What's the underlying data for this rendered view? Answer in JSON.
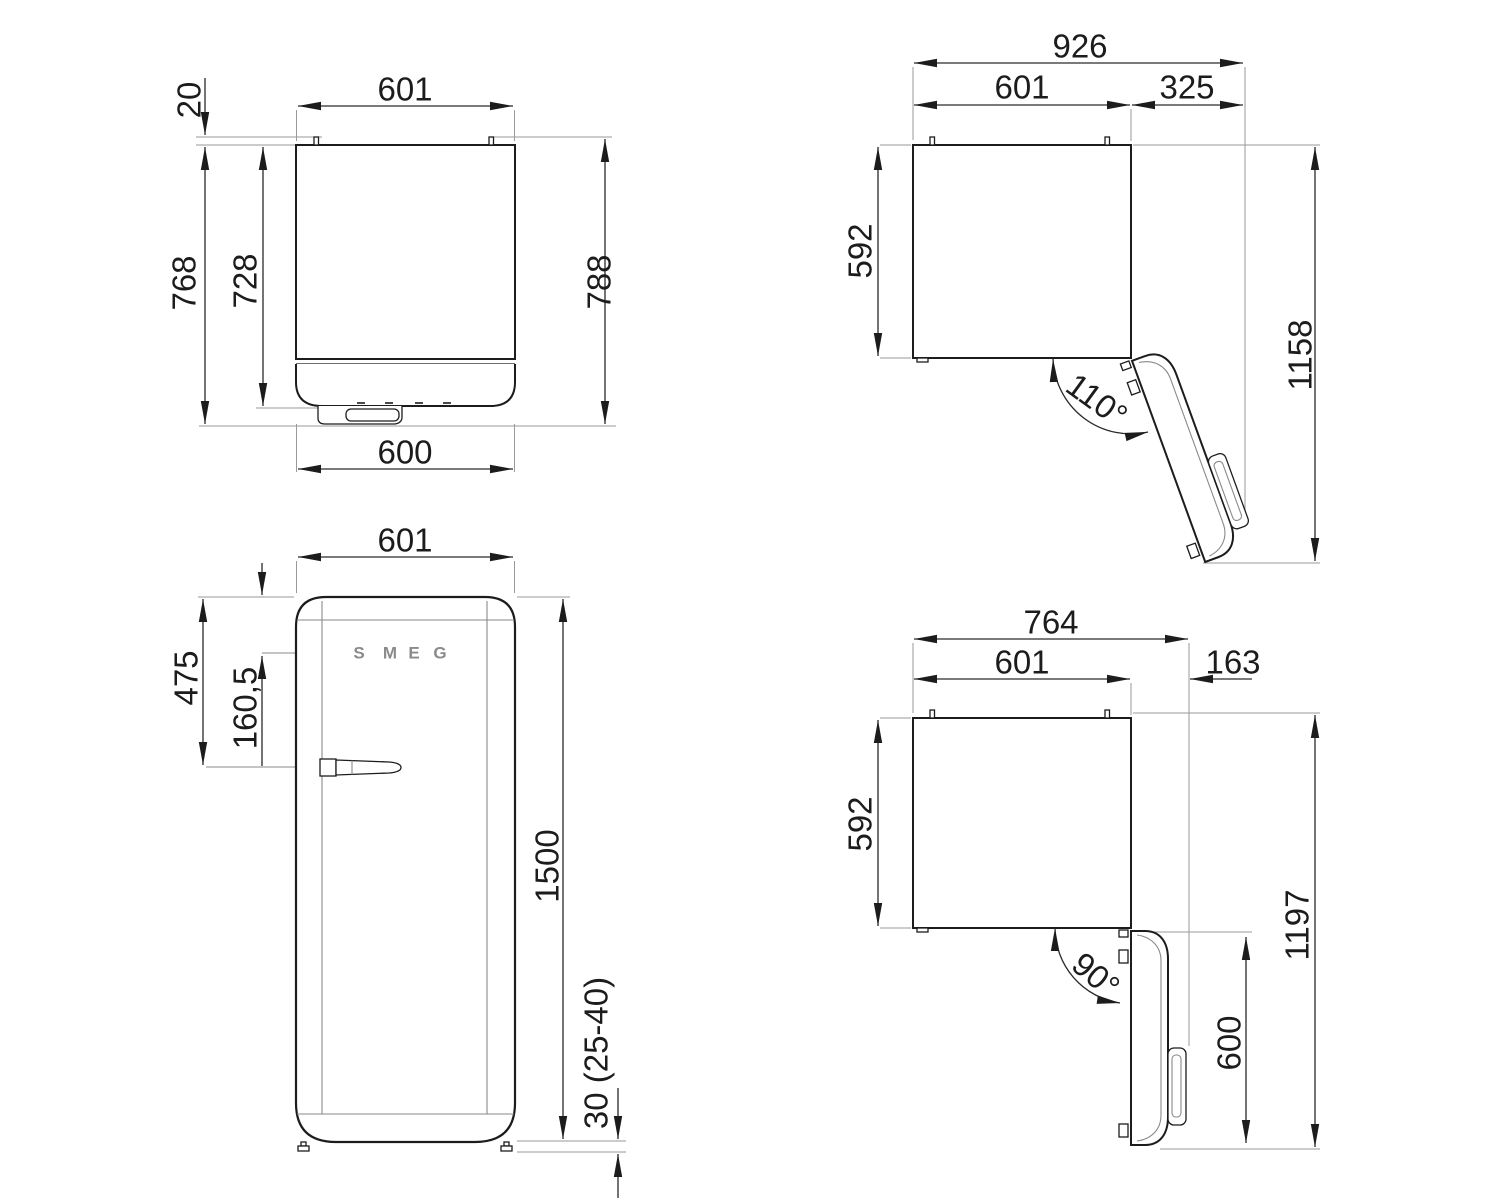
{
  "views": {
    "plan_closed": {
      "title_hint": "top view, door closed",
      "dims": {
        "width_top": "601",
        "hinge_pin_offset": "20",
        "depth_overall": "768",
        "depth_body": "728",
        "depth_with_hinges": "788",
        "door_width": "600"
      }
    },
    "plan_open_110": {
      "title_hint": "top view, door open 110 degrees",
      "dims": {
        "overall_width": "926",
        "body_width": "601",
        "door_clearance": "325",
        "body_depth": "592",
        "overall_depth_open": "1158",
        "door_angle": "110°"
      }
    },
    "front": {
      "title_hint": "front view",
      "dims": {
        "width": "601",
        "handle_top_offset": "475",
        "logo_top_offset": "160,5",
        "height": "1500",
        "feet_height": "30 (25-40)"
      },
      "logo_letters": [
        "S",
        "M",
        "E",
        "G"
      ]
    },
    "plan_open_90": {
      "title_hint": "top view, door open 90 degrees",
      "dims": {
        "overall_width": "764",
        "body_width": "601",
        "door_offset": "163",
        "body_depth": "592",
        "overall_depth_open": "1197",
        "door_depth_open": "600",
        "door_angle": "90°"
      }
    }
  },
  "colors": {
    "outline": "#1c1c1c",
    "dimension_line": "#2a2a2a",
    "extension_line": "#9a9a9a",
    "logo": "#8a8a8a",
    "background": "#ffffff"
  }
}
